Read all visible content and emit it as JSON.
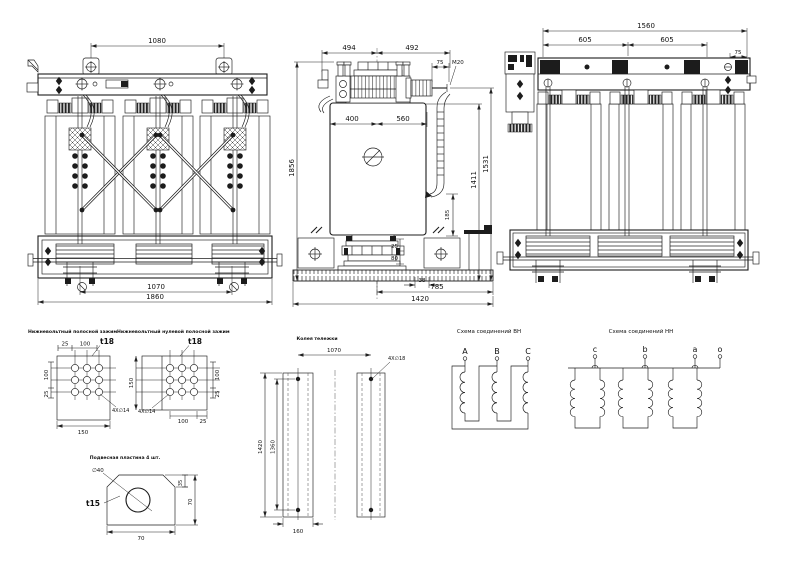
{
  "front": {
    "dim_top": "1080",
    "dim_rollers": "1070",
    "dim_width": "1860"
  },
  "side": {
    "dim_494": "494",
    "dim_492": "492",
    "dim_75": "75",
    "thread": "M20",
    "dim_400": "400",
    "dim_560": "560",
    "dim_1856": "1856",
    "dim_1411": "1411",
    "dim_1531": "1531",
    "dim_185": "185",
    "dim_25": "25",
    "dim_80": "80",
    "dim_38": "38",
    "dim_785": "785",
    "dim_1420": "1420"
  },
  "rear": {
    "dim_1560": "1560",
    "dim_605a": "605",
    "dim_605b": "605",
    "dim_75": "75"
  },
  "clamp_lv": {
    "label": "Нижневольтный полосной зажим",
    "dim_25": "25",
    "dim_100": "100",
    "thickness": "t18",
    "dim_v100": "100",
    "dim_v25": "25",
    "dim_150": "150",
    "holes": "4X∅14"
  },
  "clamp_lv_neutral": {
    "label": "Нижневольтный нулевой полосной зажим",
    "thickness": "t18",
    "dim_150": "150",
    "dim_v100": "100",
    "dim_v25": "25",
    "dim_b100": "100",
    "dim_b25": "25",
    "holes": "4X∅14"
  },
  "hang_plate": {
    "label": "Подвесная пластина 4 шт.",
    "hole": "∅40",
    "thickness": "t15",
    "dim_35": "35",
    "dim_70r": "70",
    "dim_70b": "70"
  },
  "track": {
    "label": "Колея тележки",
    "dim_1070": "1070",
    "holes": "4X∅18",
    "dim_1420": "1420",
    "dim_1360": "1360",
    "dim_160": "160"
  },
  "hv": {
    "label": "Схема соединений ВН",
    "t1": "A",
    "t2": "B",
    "t3": "C"
  },
  "lv": {
    "label": "Схема соединений НН",
    "t1": "c",
    "t2": "b",
    "t3": "a",
    "t4": "o"
  }
}
